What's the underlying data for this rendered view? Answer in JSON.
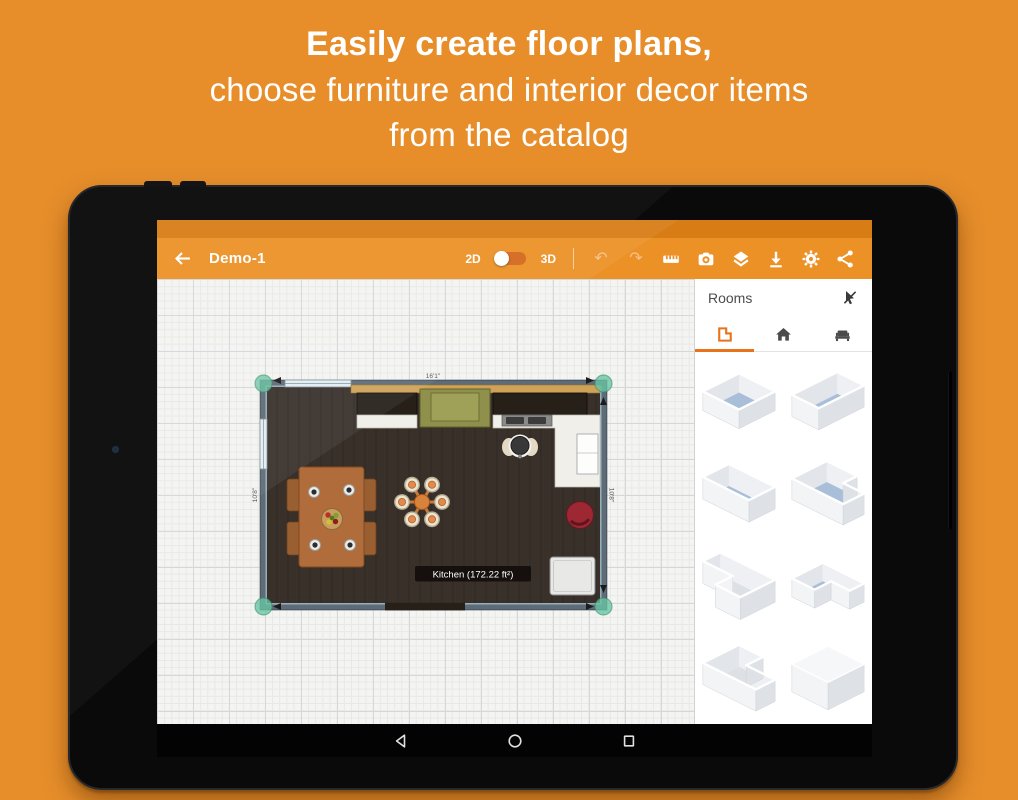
{
  "hero": {
    "line1": "Easily create floor plans,",
    "line2": "choose furniture and interior decor items",
    "line3": "from the catalog"
  },
  "colors": {
    "background": "#E78E2B",
    "toolbar": "#EC9126",
    "statusbar": "#D87C15",
    "accent": "#E8731A",
    "room_floor": "#39302A",
    "thumb_floor_blue": "#A9BFD9"
  },
  "app": {
    "toolbar": {
      "title": "Demo-1",
      "mode_2d": "2D",
      "mode_3d": "3D",
      "undo_glyph": "↶",
      "redo_glyph": "↷"
    },
    "canvas": {
      "room_label": "Kitchen (172.22 ft²)",
      "top_measure": "16'1\"",
      "side_measure": "10'8\""
    },
    "sidebar": {
      "title": "Rooms",
      "tabs": [
        {
          "name": "room-shapes"
        },
        {
          "name": "home"
        },
        {
          "name": "furniture"
        }
      ],
      "shapes": [
        {
          "name": "square-room"
        },
        {
          "name": "tall-rect-room"
        },
        {
          "name": "wide-rect-room"
        },
        {
          "name": "l-shape-room-1"
        },
        {
          "name": "l-shape-room-2"
        },
        {
          "name": "l-shape-room-3"
        },
        {
          "name": "l-shape-room-4"
        },
        {
          "name": "closed-room"
        }
      ]
    }
  }
}
